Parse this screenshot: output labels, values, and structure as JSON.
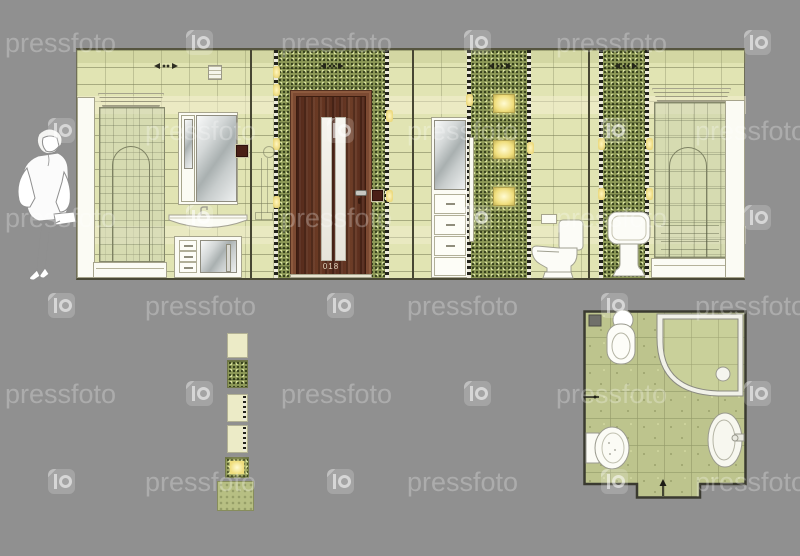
{
  "watermark": {
    "text": "pressfoto",
    "logo_glyph": "p",
    "rows": [
      {
        "y": 30,
        "items": [
          {
            "t": "text",
            "x": 5
          },
          {
            "t": "logo",
            "x": 186
          },
          {
            "t": "text",
            "x": 281
          },
          {
            "t": "logo",
            "x": 464
          },
          {
            "t": "text",
            "x": 556
          },
          {
            "t": "logo",
            "x": 744
          }
        ]
      },
      {
        "y": 118,
        "items": [
          {
            "t": "logo",
            "x": 48
          },
          {
            "t": "text",
            "x": 145
          },
          {
            "t": "logo",
            "x": 327
          },
          {
            "t": "text",
            "x": 407
          },
          {
            "t": "logo",
            "x": 601
          },
          {
            "t": "text",
            "x": 695
          }
        ]
      },
      {
        "y": 205,
        "items": [
          {
            "t": "text",
            "x": 5
          },
          {
            "t": "logo",
            "x": 186
          },
          {
            "t": "text",
            "x": 281
          },
          {
            "t": "logo",
            "x": 464
          },
          {
            "t": "text",
            "x": 556
          },
          {
            "t": "logo",
            "x": 744
          }
        ]
      },
      {
        "y": 293,
        "items": [
          {
            "t": "logo",
            "x": 48
          },
          {
            "t": "text",
            "x": 145
          },
          {
            "t": "logo",
            "x": 327
          },
          {
            "t": "text",
            "x": 407
          },
          {
            "t": "logo",
            "x": 601
          },
          {
            "t": "text",
            "x": 695
          }
        ]
      },
      {
        "y": 381,
        "items": [
          {
            "t": "text",
            "x": 5
          },
          {
            "t": "logo",
            "x": 186
          },
          {
            "t": "text",
            "x": 281
          },
          {
            "t": "logo",
            "x": 464
          },
          {
            "t": "text",
            "x": 556
          },
          {
            "t": "logo",
            "x": 744
          }
        ]
      },
      {
        "y": 469,
        "items": [
          {
            "t": "logo",
            "x": 48
          },
          {
            "t": "text",
            "x": 145
          },
          {
            "t": "logo",
            "x": 327
          },
          {
            "t": "text",
            "x": 407
          },
          {
            "t": "logo",
            "x": 601
          },
          {
            "t": "text",
            "x": 695
          }
        ]
      }
    ]
  },
  "door": {
    "label": "018"
  },
  "tile_legend": {
    "items": [
      "plain-tile",
      "mosaic-tile",
      "border-accent-tile",
      "border-accent-tile",
      "backlit-accent-tile",
      "floor-tile"
    ]
  },
  "plan": {
    "fixtures": [
      "toilet",
      "corner-shower-cabin",
      "washbasin",
      "bidet"
    ],
    "markers": [
      "section-direction-arrow",
      "entry-arrow",
      "floor-drain"
    ]
  },
  "colors": {
    "background": "#909090",
    "wall_tile": "#e1e4b3",
    "tile_grout": "#787c55",
    "mosaic_band": "#8d9957",
    "door_wood": "#5d2f1e",
    "door_frame": "#7c4a32",
    "backlit_glow": "#f0de7d",
    "plan_floor": "#bdc48d",
    "fixture_white": "#fbfbf4",
    "watermark": "rgba(255,255,255,0.26)"
  }
}
